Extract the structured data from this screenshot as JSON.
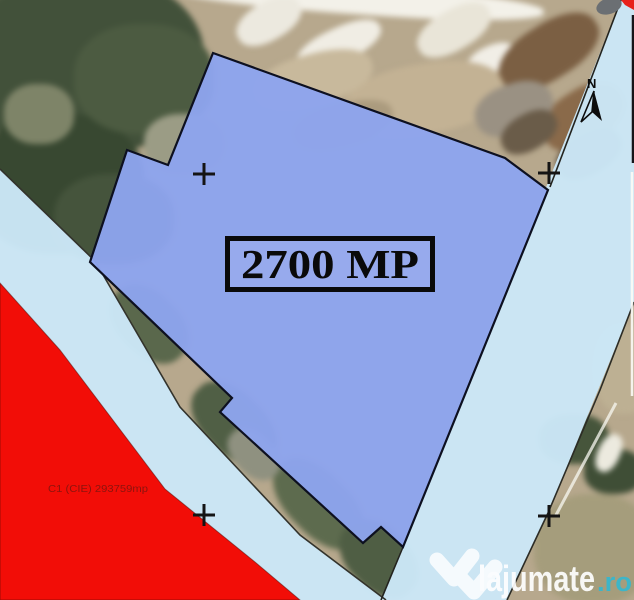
{
  "map": {
    "parcel": {
      "area_label": "2700 MP",
      "fill_color": "#8ea4ee",
      "outline_px": [
        [
          213,
          53
        ],
        [
          505,
          158
        ],
        [
          548,
          190
        ],
        [
          403,
          547
        ],
        [
          381,
          527
        ],
        [
          363,
          543
        ],
        [
          220,
          412
        ],
        [
          232,
          398
        ],
        [
          90,
          262
        ],
        [
          127,
          150
        ],
        [
          168,
          165
        ]
      ]
    },
    "red_zone": {
      "label": "C1 (CIE) 293759mp",
      "fill_color": "#f20d07",
      "label_color": "#8c140e"
    },
    "road_color": "#cbe7f7",
    "north_label": "N",
    "crosses_px": [
      [
        204,
        174
      ],
      [
        549,
        173
      ],
      [
        204,
        515
      ],
      [
        549,
        516
      ]
    ]
  },
  "watermark": {
    "brand": "lajumate",
    "tld": ".ro",
    "accent_color": "#35b8cf"
  }
}
